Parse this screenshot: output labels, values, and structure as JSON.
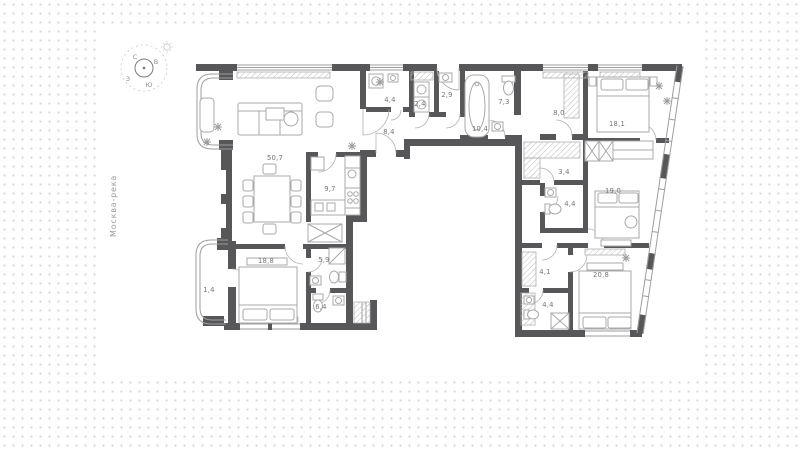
{
  "river_label": "Москва-река",
  "compass": {
    "north": "С",
    "east": "В",
    "south": "Ю",
    "west": "З"
  },
  "rooms": [
    {
      "name": "living-room",
      "area": "50,7"
    },
    {
      "name": "kitchen",
      "area": "9,7"
    },
    {
      "name": "laundry",
      "area": "4,4"
    },
    {
      "name": "storage",
      "area": "2,4"
    },
    {
      "name": "wc",
      "area": "2,9"
    },
    {
      "name": "bathroom-main",
      "area": "7,3"
    },
    {
      "name": "hall",
      "area": "8,0"
    },
    {
      "name": "corridor-a",
      "area": "8,4"
    },
    {
      "name": "corridor-b",
      "area": "10,4"
    },
    {
      "name": "bedroom-1",
      "area": "18,1"
    },
    {
      "name": "closet",
      "area": "3,4"
    },
    {
      "name": "bedroom-2",
      "area": "19,0"
    },
    {
      "name": "bathroom-2",
      "area": "4,4"
    },
    {
      "name": "wardrobe-room",
      "area": "4,1"
    },
    {
      "name": "bedroom-3",
      "area": "20,8"
    },
    {
      "name": "bathroom-3",
      "area": "4,4"
    },
    {
      "name": "bedroom-4",
      "area": "18,8"
    },
    {
      "name": "bathroom-4",
      "area": "5,9"
    },
    {
      "name": "balcony",
      "area": "1,4"
    },
    {
      "name": "cabinet",
      "area": "6,4"
    }
  ],
  "colors": {
    "wall": "#57575a",
    "line": "#a0a0a0",
    "label": "#767676",
    "dot": "#d7d7db"
  }
}
